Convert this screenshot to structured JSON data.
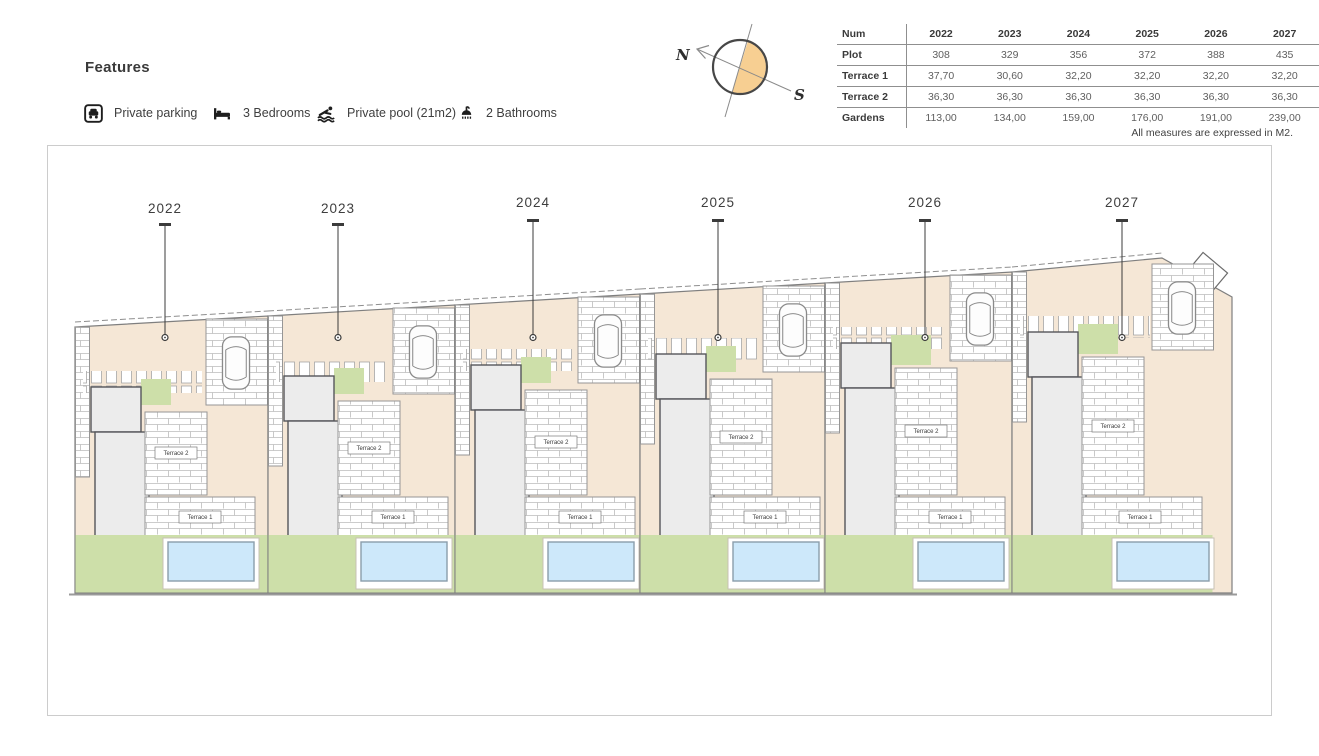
{
  "features": {
    "title": "Features",
    "items": [
      {
        "icon": "parking-icon",
        "label": "Private parking"
      },
      {
        "icon": "bed-icon",
        "label": "3 Bedrooms"
      },
      {
        "icon": "pool-icon",
        "label": "Private pool (21m2)"
      },
      {
        "icon": "bathrooms-icon",
        "label": "2 Bathrooms"
      }
    ]
  },
  "compass": {
    "north": "N",
    "south": "S",
    "accent_color": "#f7cf92"
  },
  "table": {
    "header": [
      "Num",
      "2022",
      "2023",
      "2024",
      "2025",
      "2026",
      "2027"
    ],
    "rows": [
      [
        "Plot",
        "308",
        "329",
        "356",
        "372",
        "388",
        "435"
      ],
      [
        "Terrace 1",
        "37,70",
        "30,60",
        "32,20",
        "32,20",
        "32,20",
        "32,20"
      ],
      [
        "Terrace 2",
        "36,30",
        "36,30",
        "36,30",
        "36,30",
        "36,30",
        "36,30"
      ],
      [
        "Gardens",
        "113,00",
        "134,00",
        "159,00",
        "176,00",
        "191,00",
        "239,00"
      ]
    ],
    "footnote": "All measures are expressed in M2."
  },
  "site_plan": {
    "terrace1_label": "Terrace 1",
    "terrace2_label": "Terrace 2",
    "plots": [
      {
        "label": "2022"
      },
      {
        "label": "2023"
      },
      {
        "label": "2024"
      },
      {
        "label": "2025"
      },
      {
        "label": "2026"
      },
      {
        "label": "2027"
      }
    ],
    "colors": {
      "ground": "#f5e7d6",
      "garden": "#cddfa9",
      "pool": "#cde8fa",
      "building": "#ececec"
    }
  }
}
